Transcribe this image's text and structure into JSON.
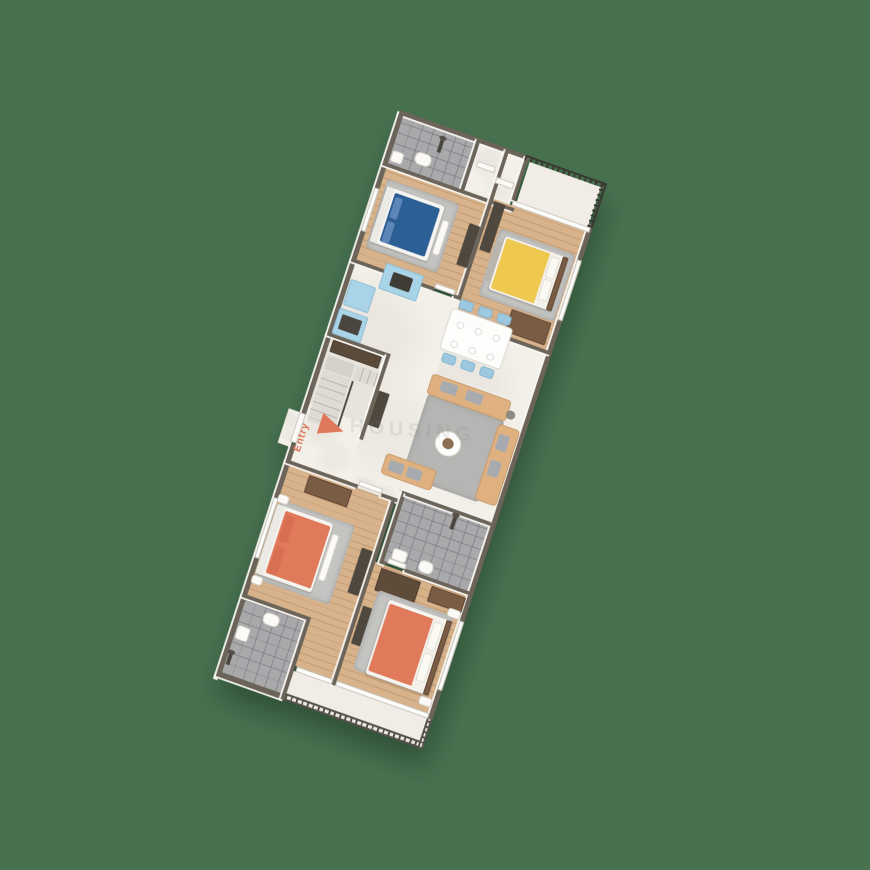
{
  "scene": {
    "background": "#47714F",
    "type": "3d-isometric-floor-plan"
  },
  "labels": {
    "entry": "Entry",
    "watermark": "HOUSING"
  },
  "palette": {
    "wall": "#6C6459",
    "wall_face": "#F9F7F2",
    "wood_floor": "#D7B28B",
    "marble_floor": "#F3F0EA",
    "tile_floor": "#A9A9AB",
    "bed_blue": "#2D5F97",
    "bed_yellow": "#EEC84F",
    "bed_orange": "#E07A5B",
    "kitchen_cabinet_blue": "#A9D3E6",
    "dining_chair_blue": "#9CC8E0",
    "sofa_tan": "#E0B180",
    "rug_grey": "#C4C4C2",
    "dark_furniture": "#4E483F",
    "brown_furniture": "#7A5C44",
    "railing_dark": "#3A362F",
    "entry_accent": "#E0795C"
  }
}
